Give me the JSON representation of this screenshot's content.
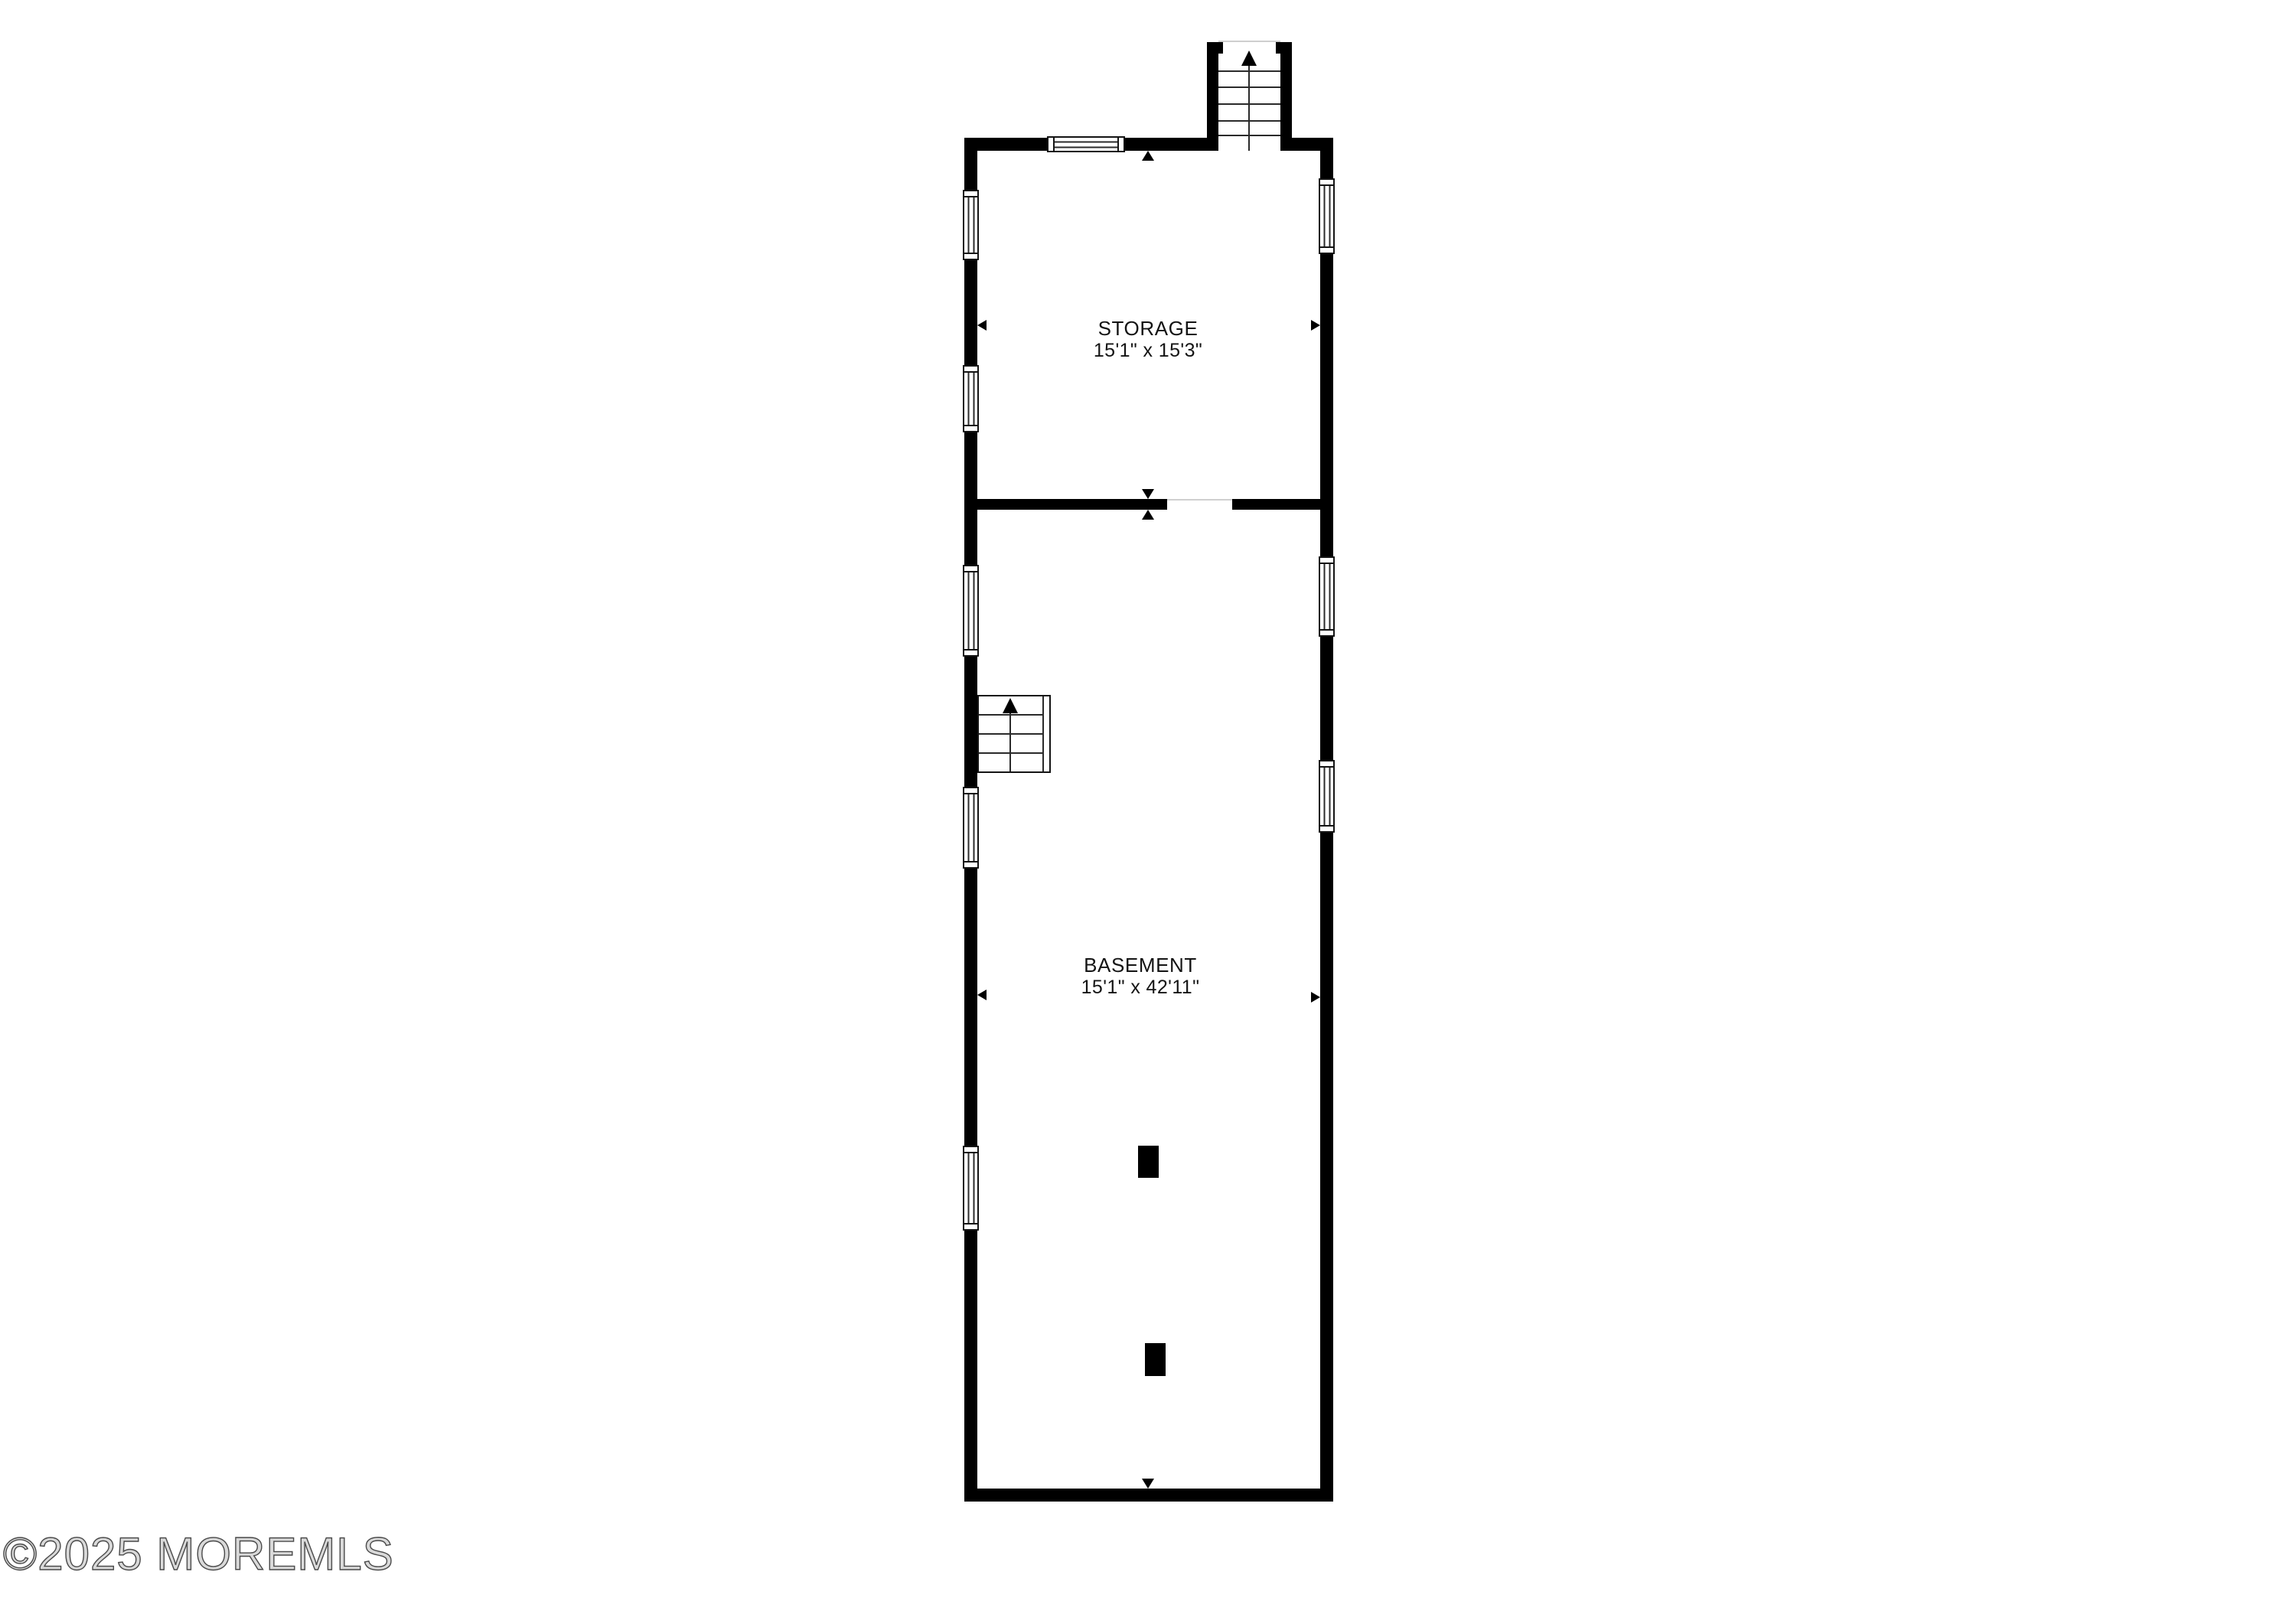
{
  "page": {
    "background_color": "#ffffff",
    "watermark_text": "©2025 MOREMLS"
  },
  "floorplan": {
    "wall_color": "#000000",
    "rooms": [
      {
        "id": "storage",
        "name": "STORAGE",
        "size": "15'1\" x 15'3\""
      },
      {
        "id": "basement",
        "name": "BASEMENT",
        "size": "15'1\" x 42'11\""
      }
    ],
    "features": {
      "staircase_count": 2,
      "window_count": 9,
      "column_count": 2,
      "door_opening_count": 1
    }
  }
}
